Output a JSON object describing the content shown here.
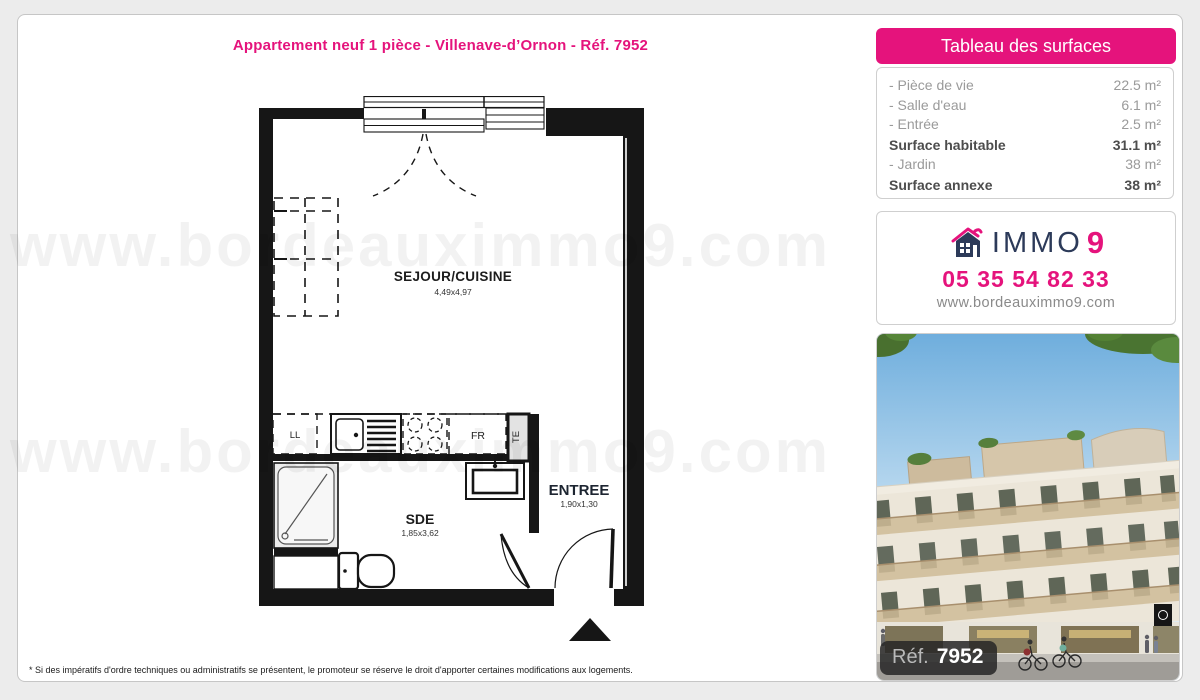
{
  "page": {
    "title": "Appartement neuf 1 pièce - Villenave-d’Ornon - Réf. 7952",
    "watermark": "www.bordeauximmo9.com",
    "footnote": "* Si des impératifs d'ordre techniques ou administratifs se présentent, le promoteur se réserve le droit d'apporter certaines modifications aux logements."
  },
  "surfaces": {
    "header": "Tableau des surfaces",
    "rows": [
      {
        "label": "- Pièce de vie",
        "value": "22.5 m²"
      },
      {
        "label": "- Salle d'eau",
        "value": "6.1 m²"
      },
      {
        "label": "- Entrée",
        "value": "2.5 m²"
      },
      {
        "label": "Surface habitable",
        "value": "31.1 m²"
      },
      {
        "label": "- Jardin",
        "value": "38 m²"
      },
      {
        "label": "Surface annexe",
        "value": "38 m²"
      }
    ]
  },
  "agency": {
    "brand_immo": "IMMO",
    "brand_9": "9",
    "phone": "05 35 54 82 33",
    "website": "www.bordeauximmo9.com"
  },
  "photo": {
    "ref_label": "Réf.",
    "ref_number": "7952"
  },
  "floorplan": {
    "sejour_name": "SEJOUR/CUISINE",
    "sejour_dims": "4,49x4,97",
    "sde_name": "SDE",
    "sde_dims": "1,85x3,62",
    "entree_name": "ENTREE",
    "entree_dims": "1,90x1,30",
    "washer": "LL",
    "fridge": "FR",
    "electrical": "TE"
  },
  "colors": {
    "pink": "#e5137c",
    "navy": "#2c3a59"
  }
}
